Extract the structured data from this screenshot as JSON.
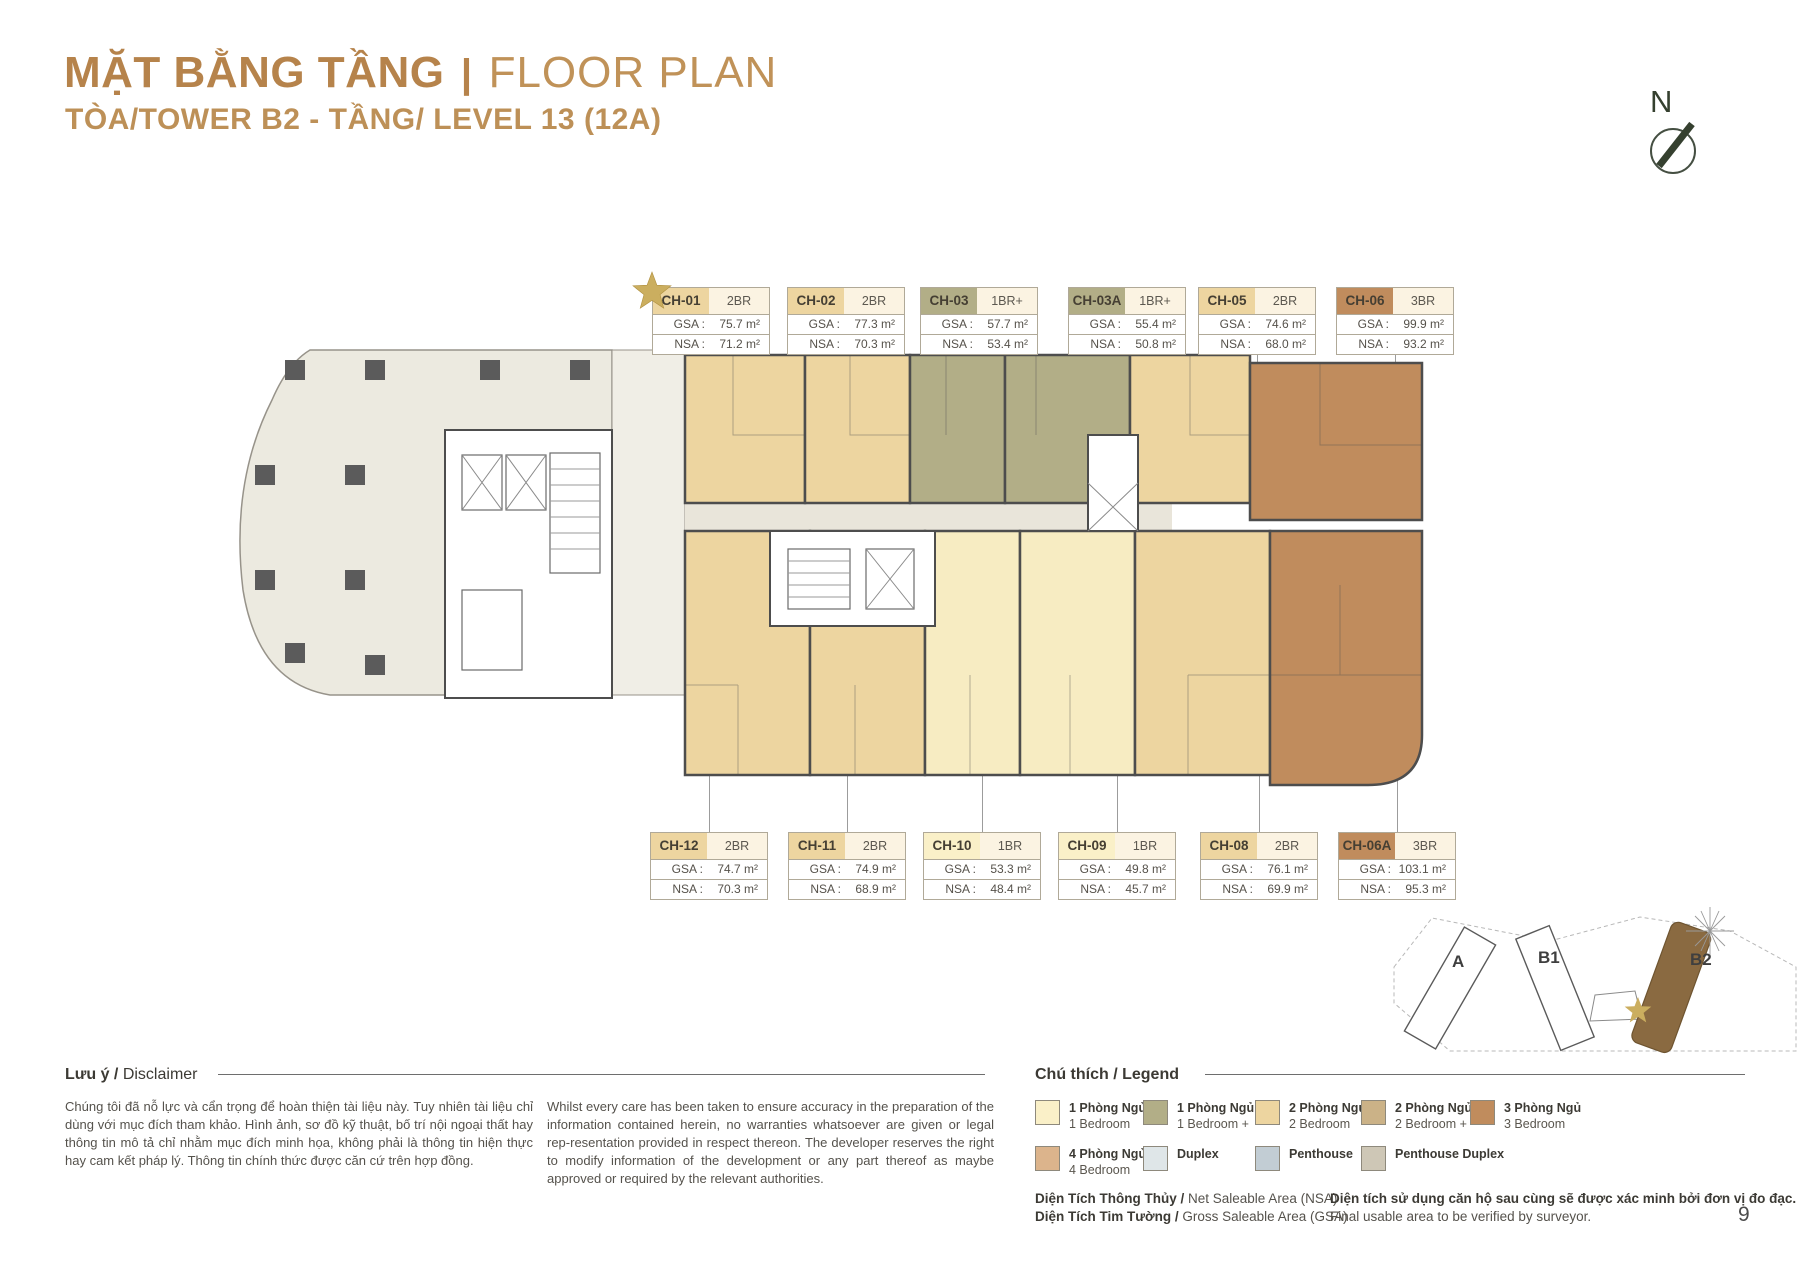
{
  "header": {
    "title_bold": "MẶT BẰNG TẦNG",
    "title_sep": "|",
    "title_light": "FLOOR PLAN",
    "subtitle": "TÒA/TOWER B2 - TẦNG/ LEVEL 13 (12A)"
  },
  "compass": {
    "label": "N"
  },
  "area_labels": {
    "gsa": "GSA :",
    "nsa": "NSA :"
  },
  "units_top": [
    {
      "id": "CH-01",
      "type": "2BR",
      "gsa": "75.7 m²",
      "nsa": "71.2 m²",
      "color": "#EDD5A0",
      "starred": true
    },
    {
      "id": "CH-02",
      "type": "2BR",
      "gsa": "77.3 m²",
      "nsa": "70.3 m²",
      "color": "#EDD5A0",
      "starred": false
    },
    {
      "id": "CH-03",
      "type": "1BR+",
      "gsa": "57.7 m²",
      "nsa": "53.4 m²",
      "color": "#B2AE87",
      "starred": false
    },
    {
      "id": "CH-03A",
      "type": "1BR+",
      "gsa": "55.4 m²",
      "nsa": "50.8 m²",
      "color": "#B2AE87",
      "starred": false
    },
    {
      "id": "CH-05",
      "type": "2BR",
      "gsa": "74.6 m²",
      "nsa": "68.0 m²",
      "color": "#EDD5A0",
      "starred": false
    },
    {
      "id": "CH-06",
      "type": "3BR",
      "gsa": "99.9 m²",
      "nsa": "93.2 m²",
      "color": "#C08C5D",
      "starred": false
    }
  ],
  "units_bottom": [
    {
      "id": "CH-12",
      "type": "2BR",
      "gsa": "74.7 m²",
      "nsa": "70.3 m²",
      "color": "#EDD5A0",
      "starred": false
    },
    {
      "id": "CH-11",
      "type": "2BR",
      "gsa": "74.9 m²",
      "nsa": "68.9 m²",
      "color": "#EDD5A0",
      "starred": false
    },
    {
      "id": "CH-10",
      "type": "1BR",
      "gsa": "53.3 m²",
      "nsa": "48.4 m²",
      "color": "#FAF0C8",
      "starred": false
    },
    {
      "id": "CH-09",
      "type": "1BR",
      "gsa": "49.8 m²",
      "nsa": "45.7 m²",
      "color": "#FAF0C8",
      "starred": false
    },
    {
      "id": "CH-08",
      "type": "2BR",
      "gsa": "76.1 m²",
      "nsa": "69.9 m²",
      "color": "#EDD5A0",
      "starred": false
    },
    {
      "id": "CH-06A",
      "type": "3BR",
      "gsa": "103.1 m²",
      "nsa": "95.3 m²",
      "color": "#C08C5D",
      "starred": false
    }
  ],
  "minimap": {
    "labels": [
      "A",
      "B1",
      "B2"
    ],
    "highlighted": "B2",
    "highlight_color": "#8A6A41"
  },
  "disclaimer": {
    "heading_bold": "Lưu ý /",
    "heading_regular": " Disclaimer",
    "text_vi": "Chúng tôi đã nỗ lực và cẩn trọng để hoàn thiện tài liệu này. Tuy nhiên tài liệu chỉ dùng với mục đích tham khảo. Hình ảnh, sơ đồ kỹ thuật, bố trí nội ngoại thất hay thông tin mô tả chỉ nhằm mục đích minh họa, không phải là thông tin hiện thực hay cam kết pháp lý. Thông tin chính thức được căn cứ trên hợp đồng.",
    "text_en": "Whilst every care has been taken to ensure accuracy in the preparation of the information contained herein, no warranties whatsoever are given or legal rep-resentation provided in respect thereon. The developer reserves the right to modify information of the development or any part thereof as maybe approved or required by the relevant authorities."
  },
  "legend": {
    "heading": "Chú thích / Legend",
    "items_row1": [
      {
        "vi": "1 Phòng Ngủ",
        "en": "1 Bedroom",
        "color": "#FAF0C8"
      },
      {
        "vi": "1 Phòng Ngủ +",
        "en": "1 Bedroom +",
        "color": "#B2AE87"
      },
      {
        "vi": "2 Phòng Ngủ",
        "en": "2 Bedroom",
        "color": "#EDD5A0"
      },
      {
        "vi": "2 Phòng Ngủ +",
        "en": "2 Bedroom +",
        "color": "#CBB287"
      },
      {
        "vi": "3 Phòng Ngủ",
        "en": "3 Bedroom",
        "color": "#C08C5D"
      }
    ],
    "items_row2": [
      {
        "vi": "4 Phòng Ngủ",
        "en": "4 Bedroom",
        "color": "#DCB48C"
      },
      {
        "vi": "Duplex",
        "en": "",
        "color": "#DFE6E8"
      },
      {
        "vi": "Penthouse",
        "en": "",
        "color": "#C2CDD4"
      },
      {
        "vi": "Penthouse Duplex",
        "en": "",
        "color": "#CEC7B6"
      }
    ]
  },
  "footnotes": {
    "nsa_bold": "Diện Tích Thông Thủy /",
    "nsa_reg": " Net Saleable Area (NSA)",
    "gsa_bold": "Diện Tích Tim Tường /",
    "gsa_reg": " Gross Saleable Area (GSA)",
    "note_bold": "Diện tích sử dụng căn hộ sau cùng sẽ được xác minh bởi đơn vị đo đạc.",
    "note_reg": "Final usable area to be verified by surveyor."
  },
  "page": {
    "number": "9"
  }
}
